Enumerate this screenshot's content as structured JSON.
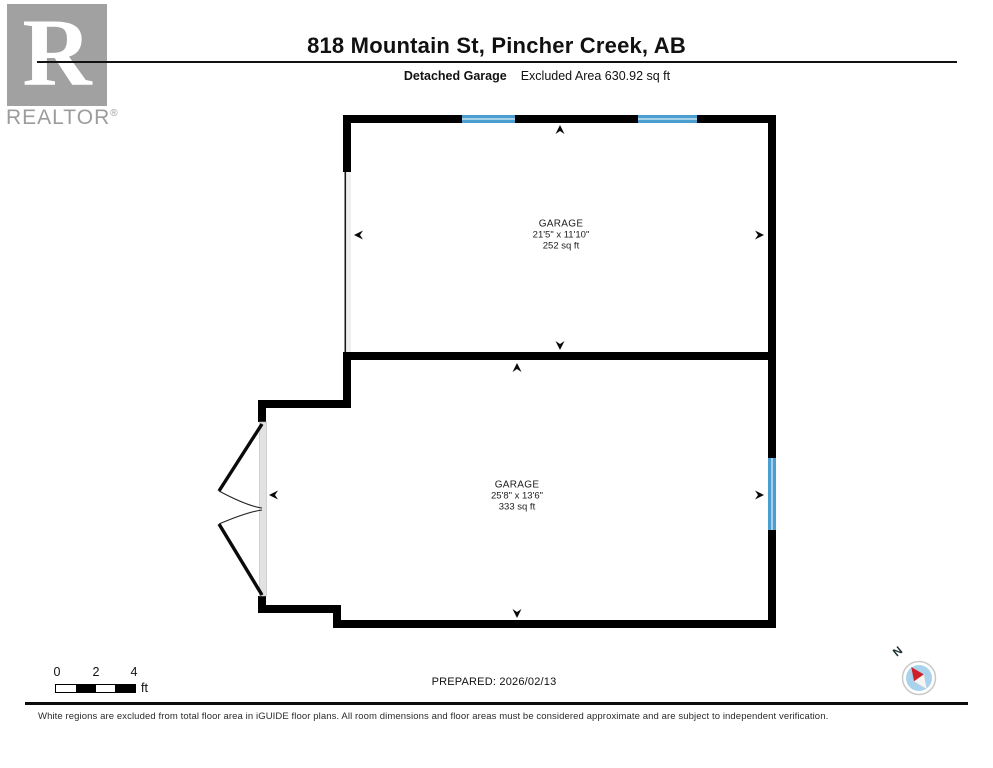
{
  "header": {
    "logo": {
      "letter": "R",
      "brand": "REALTOR",
      "registered": "®"
    },
    "title": "818 Mountain St, Pincher Creek, AB",
    "floor_label": "Detached Garage",
    "excluded_area": "Excluded Area 630.92 sq ft"
  },
  "rooms": [
    {
      "name": "GARAGE",
      "dimensions": "21'5\" x 11'10\"",
      "area": "252 sq ft"
    },
    {
      "name": "GARAGE",
      "dimensions": "25'8\" x 13'6\"",
      "area": "333 sq ft"
    }
  ],
  "scale_bar": {
    "ticks": [
      "0",
      "2",
      "4"
    ],
    "unit": "ft"
  },
  "prepared": "PREPARED: 2026/02/13",
  "compass": {
    "label": "N"
  },
  "footer": "White regions are excluded from total floor area in iGUIDE floor plans. All room dimensions and floor areas must be considered approximate and are subject to independent verification.",
  "colors": {
    "wall": "#000000",
    "window": "#4a9fd0",
    "window_light": "#a6cfe9",
    "door": "#e2e2e2",
    "logo_gray": "#a1a1a1",
    "compass_blue": "#a9d3ec",
    "compass_red": "#cf2027"
  }
}
